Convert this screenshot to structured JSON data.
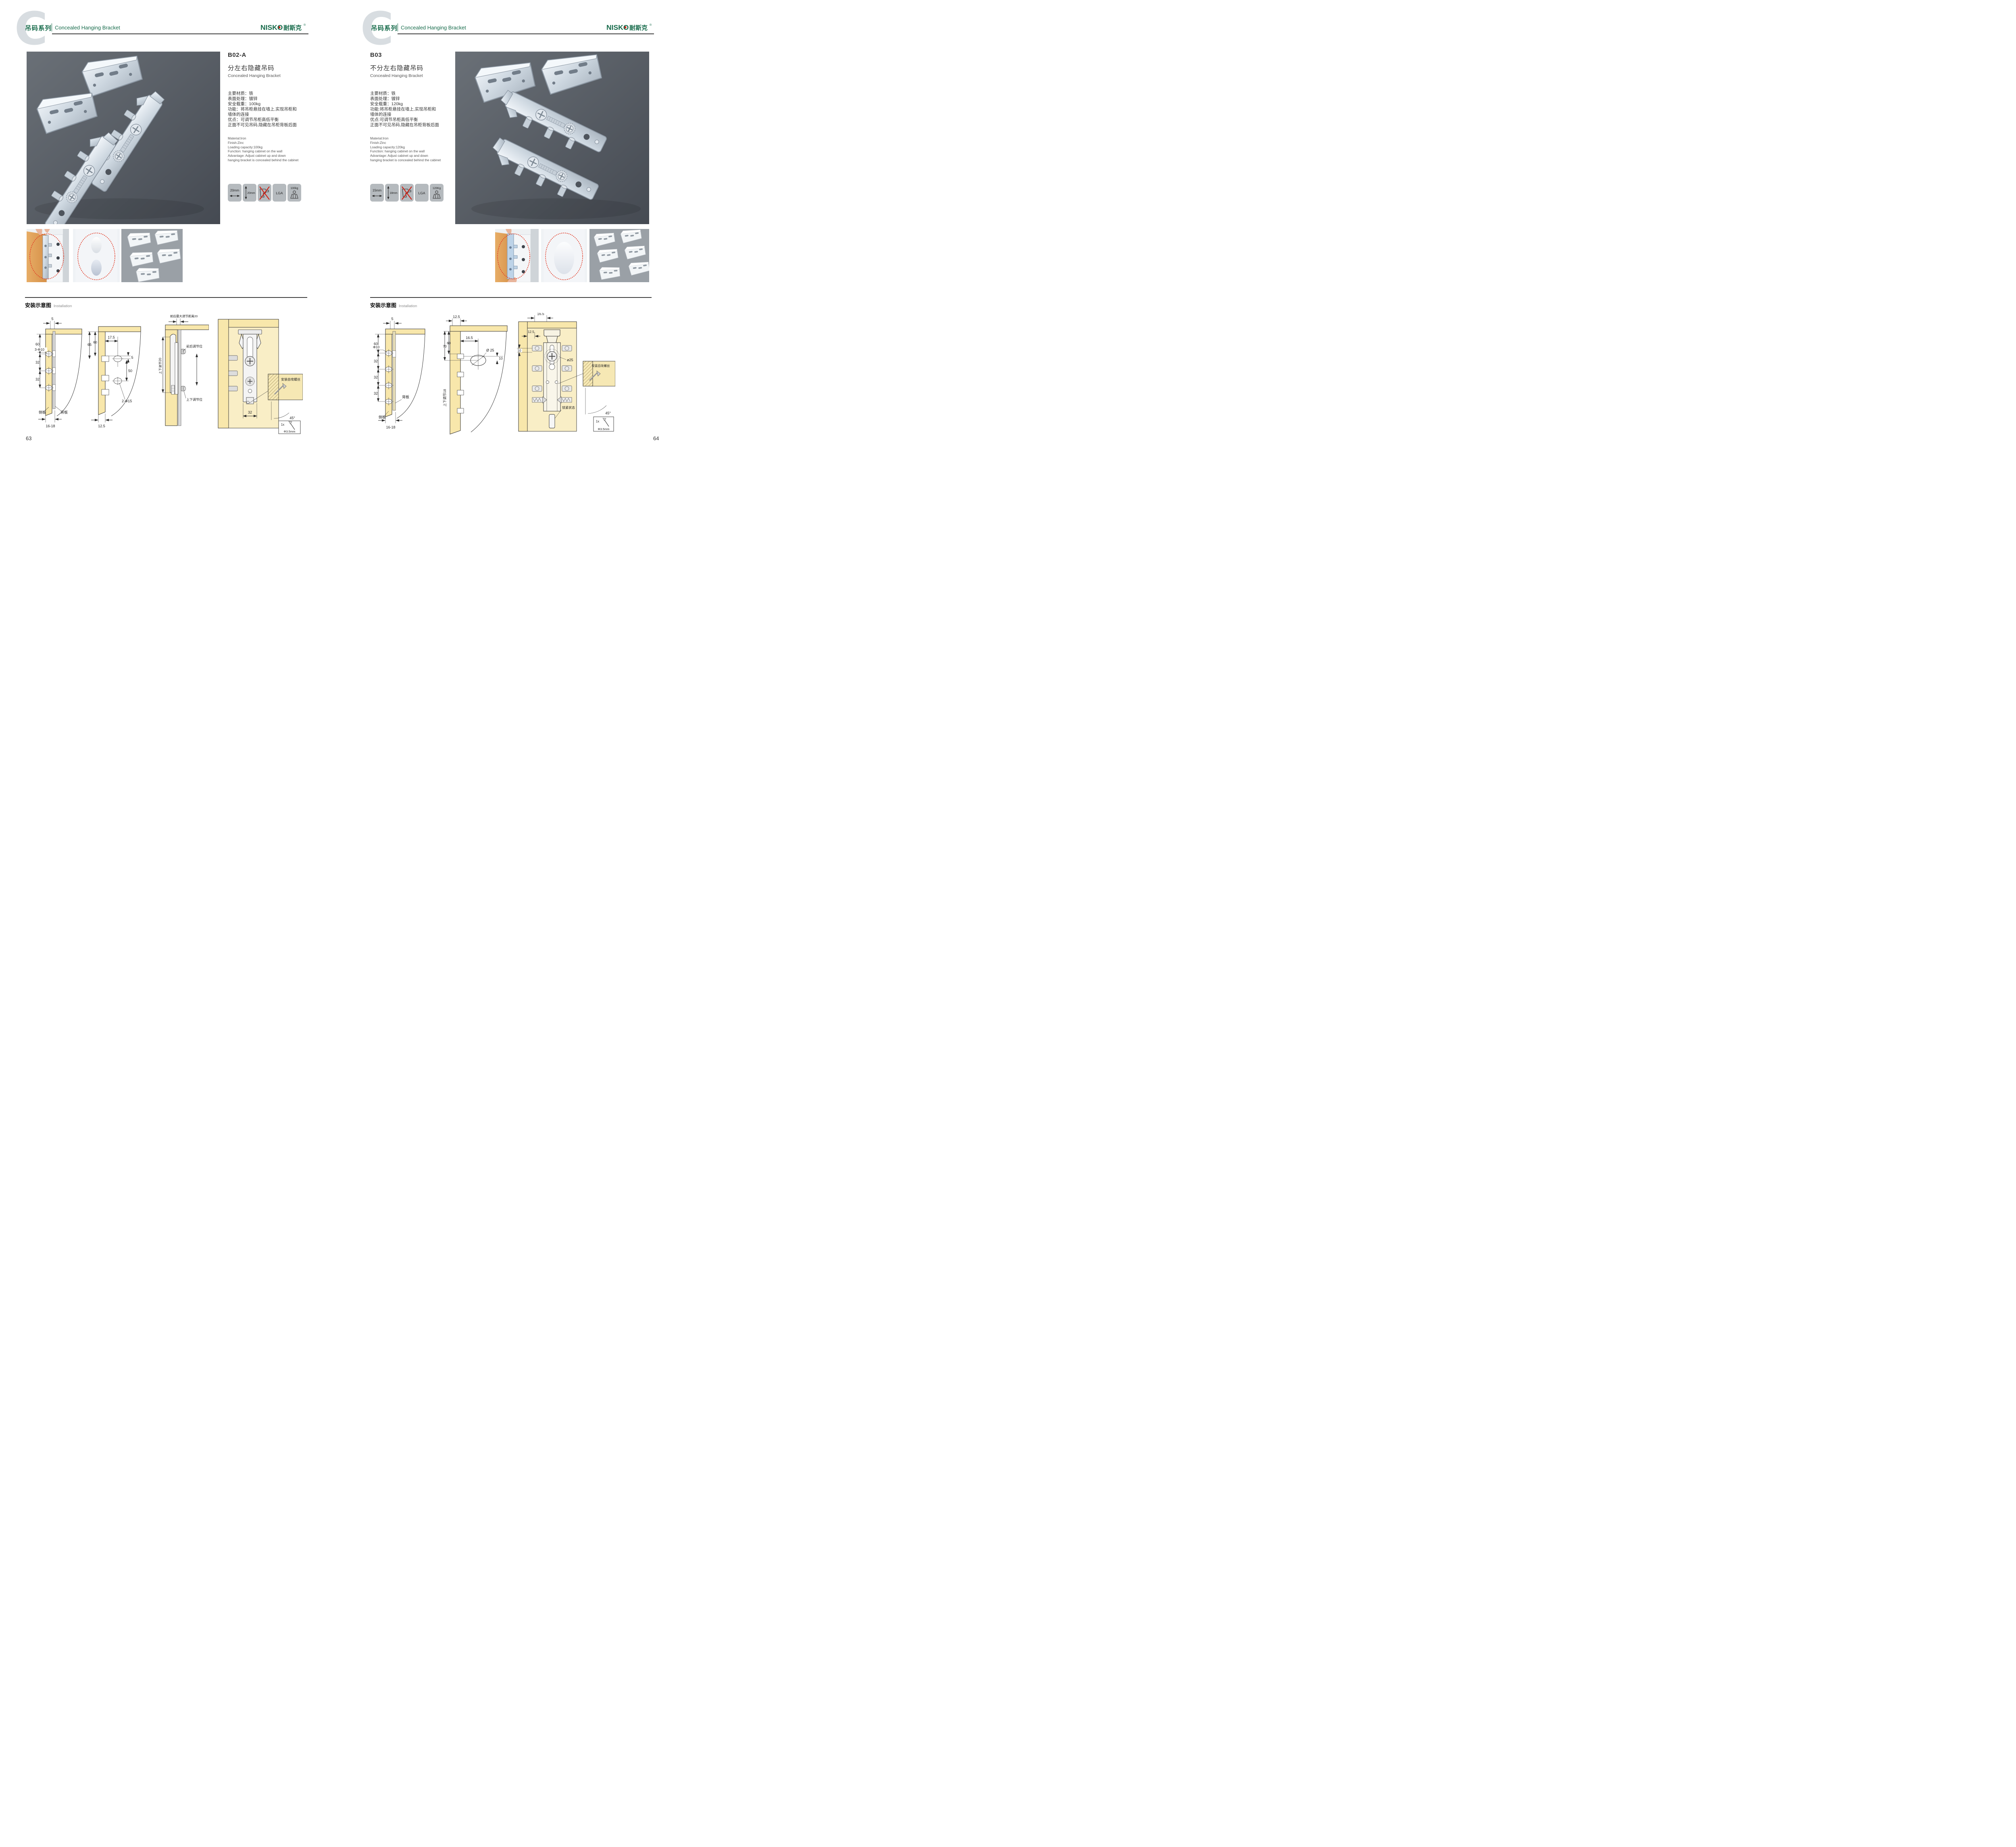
{
  "brand": {
    "name": "NISKO",
    "zh": "耐斯克",
    "reg": "®"
  },
  "header": {
    "letter": "C",
    "series_zh": "吊码系列",
    "series_en": "Concealed Hanging Bracket"
  },
  "install": {
    "zh": "安装示意图",
    "en": "Installation"
  },
  "left": {
    "page_number": "63",
    "product": {
      "code": "B02-A",
      "title_zh": "分左右隐藏吊码",
      "title_en": "Concealed Hanging Bracket",
      "specs_zh": [
        "主要材质：铁",
        "表面处理：镀锌",
        "安全载重：100kg",
        "功能：将吊柜悬挂在墙上,实现吊柜和",
        "墙体的连接",
        "优点：可调节吊柜高低平衡",
        "正面不可见吊码,隐藏在吊柜背板后面"
      ],
      "specs_en": [
        "Material:Iron",
        "Finish:Zinc",
        "Loading capacity:100kg",
        "Function: hanging cabinet on the wall",
        "Advantage: Adjust cabinet up and down",
        "hanging bracket is concealed behind the cabinet"
      ],
      "icons": {
        "w": "20mm",
        "h": "20mm",
        "cert": "LGA",
        "load": "100kg"
      }
    },
    "diagrams": {
      "d1": {
        "top": "5",
        "h1": "60",
        "hole": "3-Φ10",
        "h2": "32",
        "h3": "32",
        "side": "侧板",
        "back": "背板",
        "bottom": "16-18"
      },
      "d2": {
        "l1": "65",
        "l2": "60",
        "top": "17.5",
        "off": "5",
        "gap": "50",
        "holes": "2-Φ15",
        "bottom": "12.5"
      },
      "d3": {
        "top": "前后最大调节距离20",
        "vert": "上下调节20",
        "front": "前后调节位",
        "updown": "上下调节位"
      },
      "d4": {
        "width": "32",
        "screw": "安装自攻螺丝",
        "angle": "45°",
        "qty": "1x",
        "dia": "Φ3.5mm"
      }
    }
  },
  "right": {
    "page_number": "64",
    "product": {
      "code": "B03",
      "title_zh": "不分左右隐藏吊码",
      "title_en": "Concealed Hanging Bracket",
      "specs_zh": [
        "主要材质：铁",
        "表面处理：镀锌",
        "安全载重：120kg",
        "功能:将吊柜悬挂在墙上,实现吊柜和",
        "墙体的连接",
        "优点:可调节吊柜高低平衡",
        "正面不可见吊码,隐藏在吊柜背板后面"
      ],
      "specs_en": [
        "Material:Iron",
        "Finish:Zinc",
        "Loading capacity:120kg",
        "Function: hanging cabinet on the wall",
        "Advantage: Adjust cabinet up and down",
        "hanging bracket is concealed behind the cabinet"
      ],
      "icons": {
        "w": "15mm",
        "h": "18mm",
        "cert": "LGA",
        "load": "120Kg"
      }
    },
    "diagrams": {
      "d1": {
        "top": "5",
        "h1": "60",
        "hole": "Φ10",
        "h2": "32",
        "h3": "32",
        "h4": "32",
        "back": "背板",
        "side": "侧板",
        "bottom": "16-18"
      },
      "d2": {
        "top": "12.5",
        "l1": "70",
        "l2": "60",
        "inset": "16.5",
        "dia": "Ø 25",
        "off": "10",
        "vert": "上下调节18"
      },
      "d3": {
        "top": "16.5",
        "left": "12.5",
        "off": "10",
        "dia": "ø25",
        "lock": "锁紧状态",
        "screw": "安装自攻螺丝",
        "angle": "45°",
        "qty": "1x",
        "sdia": "Φ3.5mm"
      }
    }
  }
}
